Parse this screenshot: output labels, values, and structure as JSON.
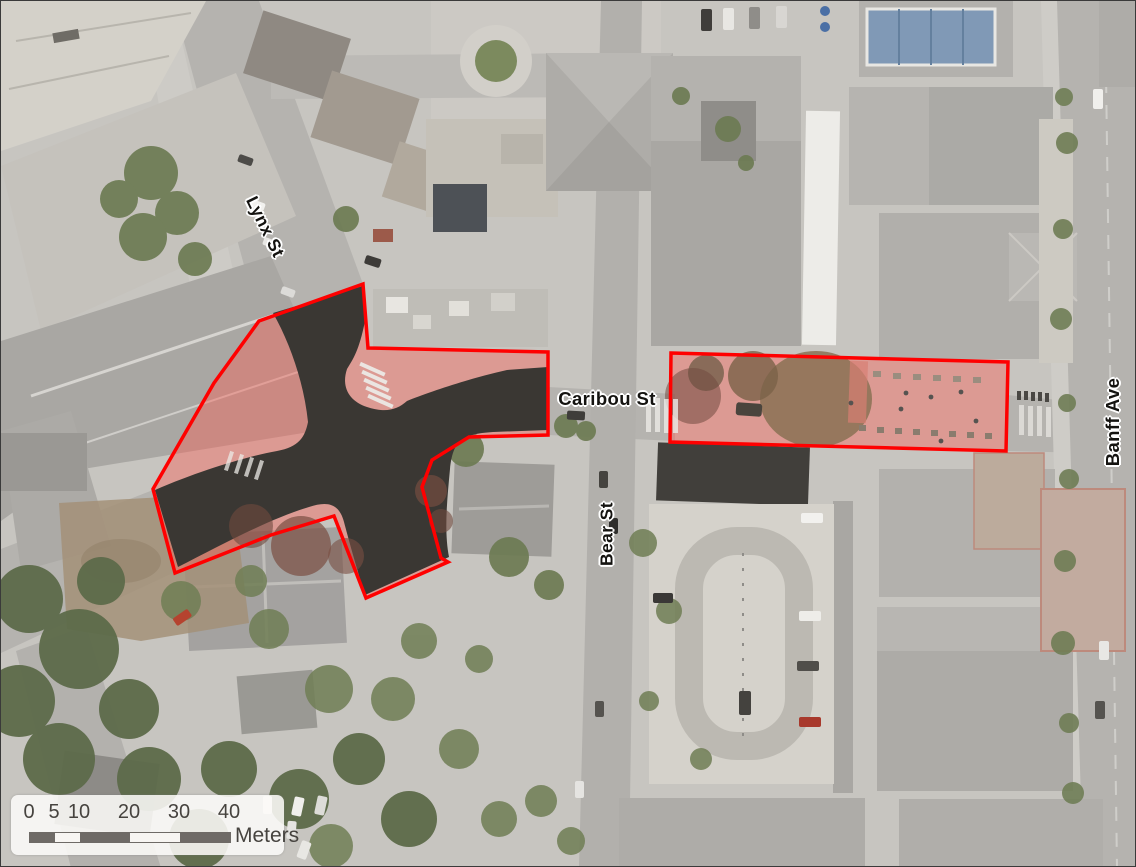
{
  "map": {
    "streets": {
      "lynx": {
        "label": "Lynx St"
      },
      "caribou": {
        "label": "Caribou St"
      },
      "bear": {
        "label": "Bear St"
      },
      "banff": {
        "label": "Banff Ave"
      }
    },
    "scale_bar": {
      "ticks": [
        "0",
        "5",
        "10",
        "20",
        "30",
        "40"
      ],
      "unit": "Meters"
    },
    "colors": {
      "highlight_outline": "#ff0000",
      "highlight_fill": "rgba(250,95,85,0.42)",
      "road_closure": "#3a3733",
      "scalebar_dark": "#6e6a66",
      "label_text": "#141310",
      "label_halo": "#ffffff"
    }
  }
}
